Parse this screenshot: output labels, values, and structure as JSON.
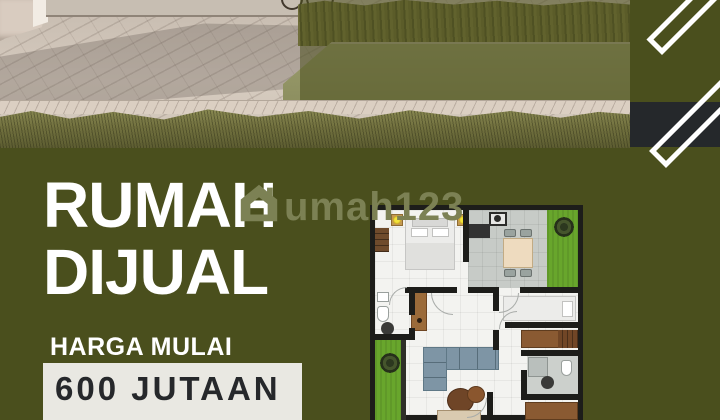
{
  "poster": {
    "headline_line1": "RUMAH",
    "headline_line2": "DIJUAL",
    "price_label": "HARGA MULAI",
    "price_value": "600 JUTAAN",
    "watermark_text": "umah123"
  },
  "icons": {
    "watermark_house": "house-icon"
  },
  "colors": {
    "olive": "#4a4f1d",
    "overlay": "rgba(74,79,29,0.55)",
    "dark_band": "#25282b",
    "price_box": "#e9e8e2",
    "price_text": "#26282b",
    "watermark": "#7c8154",
    "headline_text": "#ffffff",
    "plan_grass": "#68a62c",
    "plan_wall": "#1d1d1a"
  }
}
